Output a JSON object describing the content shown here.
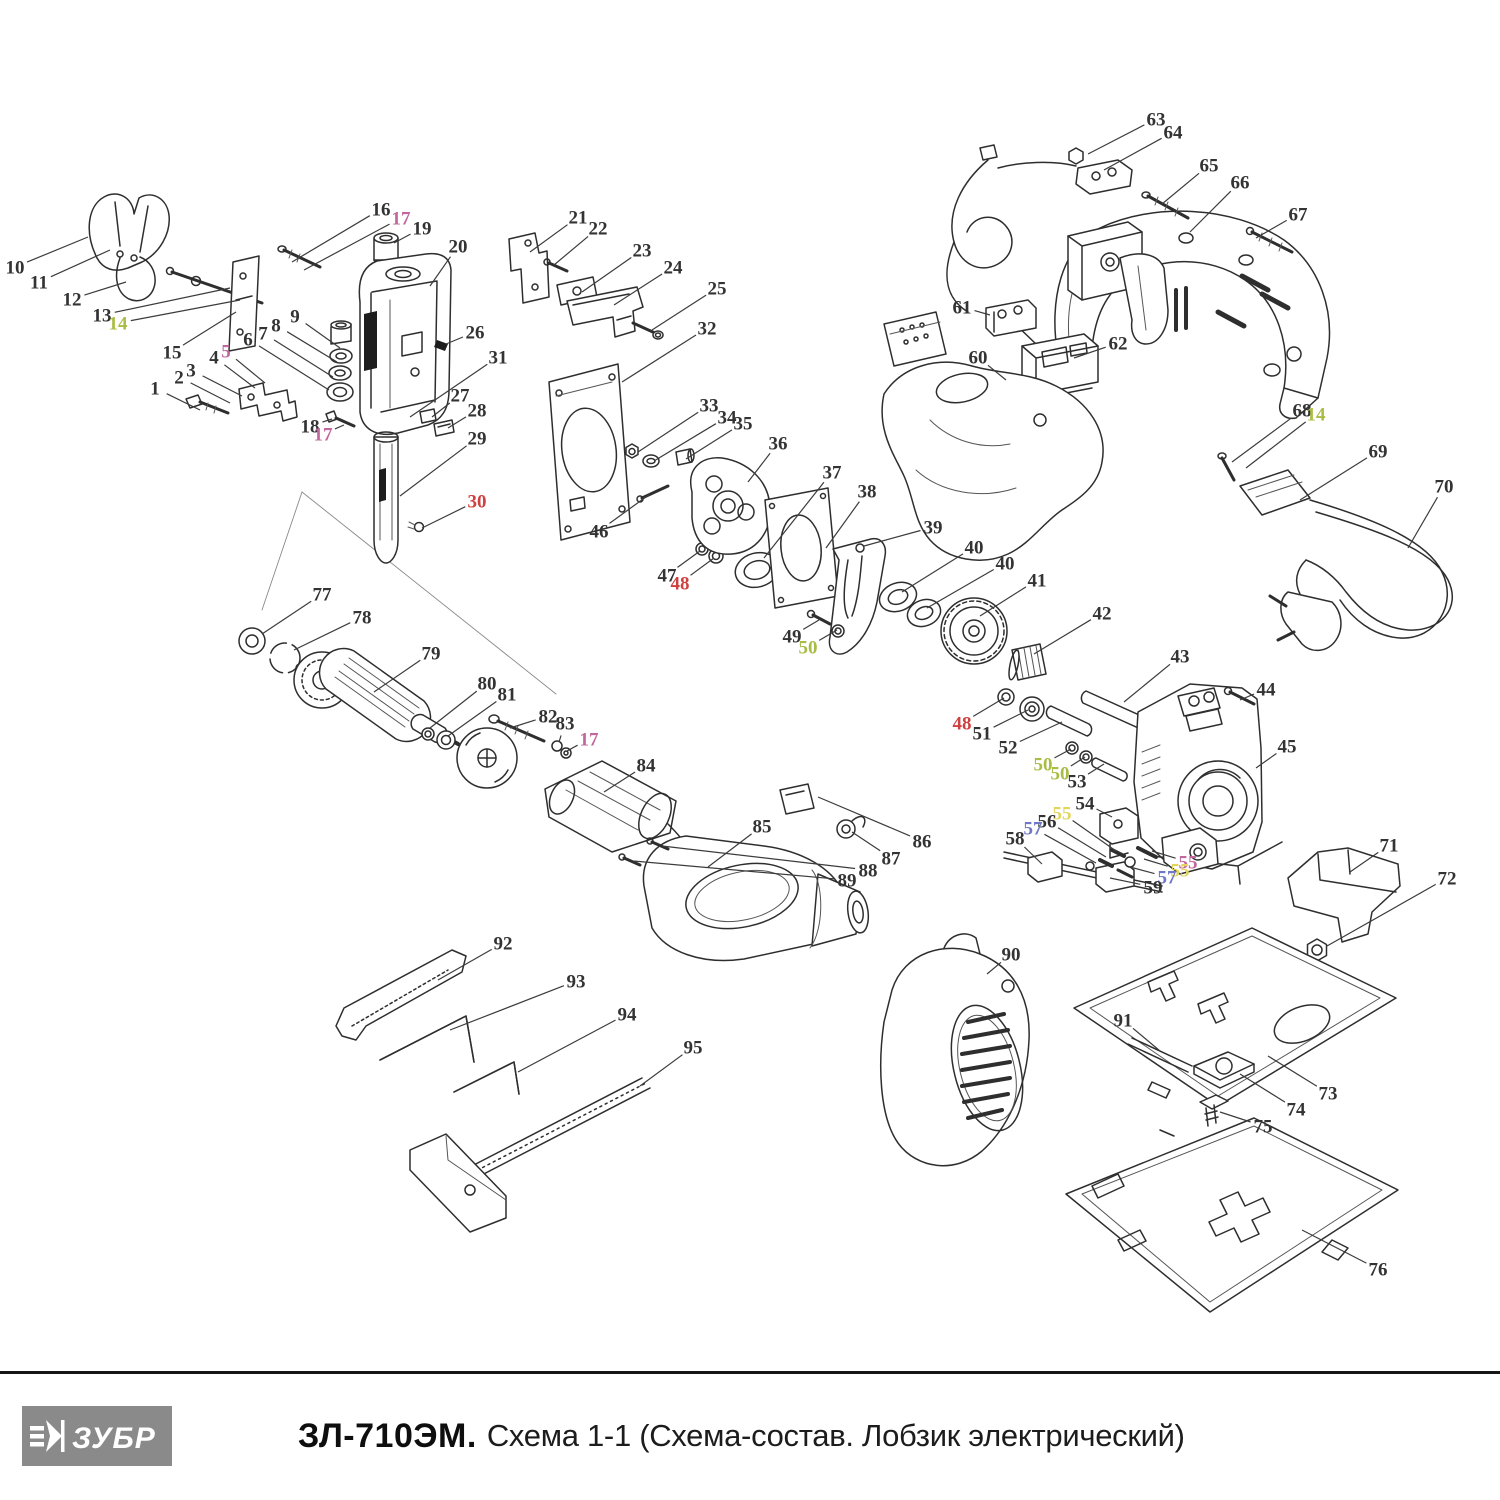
{
  "footer": {
    "brand": "ЗУБР",
    "model": "ЗЛ-710ЭМ.",
    "subtitle": "Схема 1-1 (Схема-состав. Лобзик электрический)",
    "logo_bg": "#8a8a8a"
  },
  "palette": {
    "k": "#333333",
    "r": "#cf4040",
    "p": "#c2679e",
    "g": "#a9bc45",
    "y": "#e3d45c",
    "b": "#6f78c8"
  },
  "diagram": {
    "description": "Exploded parts diagram of electric jigsaw ZL-710EM, schema 1-1",
    "leader_color": "#3c3c3c",
    "labels": [
      {
        "t": "1",
        "x": 155,
        "y": 388,
        "tx": 200,
        "ty": 410,
        "c": "k"
      },
      {
        "t": "2",
        "x": 179,
        "y": 377,
        "tx": 230,
        "ty": 403,
        "c": "k"
      },
      {
        "t": "3",
        "x": 191,
        "y": 370,
        "tx": 242,
        "ty": 396,
        "c": "k"
      },
      {
        "t": "4",
        "x": 214,
        "y": 357,
        "tx": 255,
        "ty": 388,
        "c": "k"
      },
      {
        "t": "5",
        "x": 226,
        "y": 351,
        "tx": 265,
        "ty": 383,
        "c": "p"
      },
      {
        "t": "6",
        "x": 248,
        "y": 339,
        "tx": 329,
        "ty": 390,
        "c": "k"
      },
      {
        "t": "7",
        "x": 263,
        "y": 333,
        "tx": 333,
        "ty": 377,
        "c": "k"
      },
      {
        "t": "8",
        "x": 276,
        "y": 325,
        "tx": 337,
        "ty": 362,
        "c": "k"
      },
      {
        "t": "9",
        "x": 295,
        "y": 316,
        "tx": 340,
        "ty": 348,
        "c": "k"
      },
      {
        "t": "10",
        "x": 15,
        "y": 267,
        "tx": 88,
        "ty": 237,
        "c": "k"
      },
      {
        "t": "11",
        "x": 39,
        "y": 282,
        "tx": 110,
        "ty": 250,
        "c": "k"
      },
      {
        "t": "12",
        "x": 72,
        "y": 299,
        "tx": 126,
        "ty": 282,
        "c": "k"
      },
      {
        "t": "13",
        "x": 102,
        "y": 315,
        "tx": 230,
        "ty": 288,
        "c": "k"
      },
      {
        "t": "14",
        "x": 118,
        "y": 323,
        "tx": 240,
        "ty": 300,
        "c": "g"
      },
      {
        "t": "15",
        "x": 172,
        "y": 352,
        "tx": 236,
        "ty": 312,
        "c": "k"
      },
      {
        "t": "16",
        "x": 381,
        "y": 209,
        "tx": 292,
        "ty": 262,
        "c": "k"
      },
      {
        "t": "17",
        "x": 401,
        "y": 218,
        "tx": 304,
        "ty": 270,
        "c": "p"
      },
      {
        "t": "18",
        "x": 310,
        "y": 426,
        "tx": 332,
        "ty": 419,
        "c": "k"
      },
      {
        "t": "17",
        "x": 323,
        "y": 434,
        "tx": 344,
        "ty": 425,
        "c": "p"
      },
      {
        "t": "19",
        "x": 422,
        "y": 228,
        "tx": 394,
        "ty": 243,
        "c": "k"
      },
      {
        "t": "20",
        "x": 458,
        "y": 246,
        "tx": 430,
        "ty": 286,
        "c": "k"
      },
      {
        "t": "21",
        "x": 578,
        "y": 217,
        "tx": 530,
        "ty": 252,
        "c": "k"
      },
      {
        "t": "22",
        "x": 598,
        "y": 228,
        "tx": 554,
        "ty": 265,
        "c": "k"
      },
      {
        "t": "23",
        "x": 642,
        "y": 250,
        "tx": 582,
        "ty": 292,
        "c": "k"
      },
      {
        "t": "24",
        "x": 673,
        "y": 267,
        "tx": 614,
        "ty": 305,
        "c": "k"
      },
      {
        "t": "25",
        "x": 717,
        "y": 288,
        "tx": 652,
        "ty": 330,
        "c": "k"
      },
      {
        "t": "26",
        "x": 475,
        "y": 332,
        "tx": 446,
        "ty": 344,
        "c": "k"
      },
      {
        "t": "27",
        "x": 460,
        "y": 395,
        "tx": 432,
        "ty": 417,
        "c": "k"
      },
      {
        "t": "28",
        "x": 477,
        "y": 410,
        "tx": 448,
        "ty": 428,
        "c": "k"
      },
      {
        "t": "29",
        "x": 477,
        "y": 438,
        "tx": 400,
        "ty": 496,
        "c": "k"
      },
      {
        "t": "30",
        "x": 477,
        "y": 501,
        "tx": 422,
        "ty": 528,
        "c": "r"
      },
      {
        "t": "31",
        "x": 498,
        "y": 357,
        "tx": 410,
        "ty": 417,
        "c": "k"
      },
      {
        "t": "32",
        "x": 707,
        "y": 328,
        "tx": 622,
        "ty": 382,
        "c": "k"
      },
      {
        "t": "33",
        "x": 709,
        "y": 405,
        "tx": 638,
        "ty": 452,
        "c": "k"
      },
      {
        "t": "34",
        "x": 727,
        "y": 417,
        "tx": 654,
        "ty": 461,
        "c": "k"
      },
      {
        "t": "35",
        "x": 743,
        "y": 423,
        "tx": 686,
        "ty": 459,
        "c": "k"
      },
      {
        "t": "36",
        "x": 778,
        "y": 443,
        "tx": 748,
        "ty": 482,
        "c": "k"
      },
      {
        "t": "37",
        "x": 832,
        "y": 472,
        "tx": 764,
        "ty": 558,
        "c": "k"
      },
      {
        "t": "38",
        "x": 867,
        "y": 491,
        "tx": 826,
        "ty": 548,
        "c": "k"
      },
      {
        "t": "39",
        "x": 933,
        "y": 527,
        "tx": 864,
        "ty": 546,
        "c": "k"
      },
      {
        "t": "40",
        "x": 974,
        "y": 547,
        "tx": 902,
        "ty": 592,
        "c": "k"
      },
      {
        "t": "40",
        "x": 1005,
        "y": 563,
        "tx": 927,
        "ty": 608,
        "c": "k"
      },
      {
        "t": "41",
        "x": 1037,
        "y": 580,
        "tx": 980,
        "ty": 616,
        "c": "k"
      },
      {
        "t": "42",
        "x": 1102,
        "y": 613,
        "tx": 1034,
        "ty": 654,
        "c": "k"
      },
      {
        "t": "43",
        "x": 1180,
        "y": 656,
        "tx": 1124,
        "ty": 702,
        "c": "k"
      },
      {
        "t": "44",
        "x": 1266,
        "y": 689,
        "tx": 1240,
        "ty": 700,
        "c": "k"
      },
      {
        "t": "45",
        "x": 1287,
        "y": 746,
        "tx": 1256,
        "ty": 768,
        "c": "k"
      },
      {
        "t": "46",
        "x": 599,
        "y": 531,
        "tx": 650,
        "ty": 494,
        "c": "k"
      },
      {
        "t": "47",
        "x": 667,
        "y": 575,
        "tx": 700,
        "ty": 551,
        "c": "k"
      },
      {
        "t": "48",
        "x": 680,
        "y": 583,
        "tx": 714,
        "ty": 558,
        "c": "r"
      },
      {
        "t": "49",
        "x": 792,
        "y": 636,
        "tx": 819,
        "ty": 620,
        "c": "k"
      },
      {
        "t": "50",
        "x": 808,
        "y": 647,
        "tx": 837,
        "ty": 630,
        "c": "g"
      },
      {
        "t": "48",
        "x": 962,
        "y": 723,
        "tx": 1004,
        "ty": 698,
        "c": "r"
      },
      {
        "t": "51",
        "x": 982,
        "y": 733,
        "tx": 1028,
        "ty": 710,
        "c": "k"
      },
      {
        "t": "52",
        "x": 1008,
        "y": 747,
        "tx": 1062,
        "ty": 722,
        "c": "k"
      },
      {
        "t": "50",
        "x": 1043,
        "y": 764,
        "tx": 1071,
        "ty": 749,
        "c": "g"
      },
      {
        "t": "50",
        "x": 1060,
        "y": 773,
        "tx": 1085,
        "ty": 757,
        "c": "g"
      },
      {
        "t": "53",
        "x": 1077,
        "y": 781,
        "tx": 1104,
        "ty": 764,
        "c": "k"
      },
      {
        "t": "54",
        "x": 1085,
        "y": 803,
        "tx": 1112,
        "ty": 817,
        "c": "k"
      },
      {
        "t": "55",
        "x": 1062,
        "y": 813,
        "tx": 1116,
        "ty": 851,
        "c": "y"
      },
      {
        "t": "56",
        "x": 1047,
        "y": 821,
        "tx": 1106,
        "ty": 857,
        "c": "k"
      },
      {
        "t": "57",
        "x": 1033,
        "y": 828,
        "tx": 1096,
        "ty": 863,
        "c": "b"
      },
      {
        "t": "58",
        "x": 1015,
        "y": 838,
        "tx": 1042,
        "ty": 864,
        "c": "k"
      },
      {
        "t": "55",
        "x": 1188,
        "y": 862,
        "tx": 1152,
        "ty": 851,
        "c": "p"
      },
      {
        "t": "55",
        "x": 1180,
        "y": 870,
        "tx": 1144,
        "ty": 859,
        "c": "y"
      },
      {
        "t": "57",
        "x": 1167,
        "y": 877,
        "tx": 1130,
        "ty": 867,
        "c": "b"
      },
      {
        "t": "59",
        "x": 1153,
        "y": 887,
        "tx": 1110,
        "ty": 878,
        "c": "k"
      },
      {
        "t": "60",
        "x": 978,
        "y": 357,
        "tx": 1006,
        "ty": 380,
        "c": "k"
      },
      {
        "t": "61",
        "x": 962,
        "y": 307,
        "tx": 990,
        "ty": 315,
        "c": "k"
      },
      {
        "t": "62",
        "x": 1118,
        "y": 343,
        "tx": 1074,
        "ty": 358,
        "c": "k"
      },
      {
        "t": "63",
        "x": 1156,
        "y": 119,
        "tx": 1088,
        "ty": 154,
        "c": "k"
      },
      {
        "t": "64",
        "x": 1173,
        "y": 132,
        "tx": 1104,
        "ty": 170,
        "c": "k"
      },
      {
        "t": "65",
        "x": 1209,
        "y": 165,
        "tx": 1162,
        "ty": 204,
        "c": "k"
      },
      {
        "t": "66",
        "x": 1240,
        "y": 182,
        "tx": 1190,
        "ty": 232,
        "c": "k"
      },
      {
        "t": "67",
        "x": 1298,
        "y": 214,
        "tx": 1256,
        "ty": 238,
        "c": "k"
      },
      {
        "t": "68",
        "x": 1302,
        "y": 410,
        "tx": 1232,
        "ty": 462,
        "c": "k"
      },
      {
        "t": "14",
        "x": 1316,
        "y": 414,
        "tx": 1246,
        "ty": 468,
        "c": "g"
      },
      {
        "t": "69",
        "x": 1378,
        "y": 451,
        "tx": 1300,
        "ty": 500,
        "c": "k"
      },
      {
        "t": "70",
        "x": 1444,
        "y": 486,
        "tx": 1408,
        "ty": 548,
        "c": "k"
      },
      {
        "t": "71",
        "x": 1389,
        "y": 845,
        "tx": 1350,
        "ty": 872,
        "c": "k"
      },
      {
        "t": "72",
        "x": 1447,
        "y": 878,
        "tx": 1327,
        "ty": 946,
        "c": "k"
      },
      {
        "t": "73",
        "x": 1328,
        "y": 1093,
        "tx": 1268,
        "ty": 1056,
        "c": "k"
      },
      {
        "t": "74",
        "x": 1296,
        "y": 1109,
        "tx": 1240,
        "ty": 1074,
        "c": "k"
      },
      {
        "t": "75",
        "x": 1263,
        "y": 1126,
        "tx": 1220,
        "ty": 1112,
        "c": "k"
      },
      {
        "t": "76",
        "x": 1378,
        "y": 1269,
        "tx": 1302,
        "ty": 1230,
        "c": "k"
      },
      {
        "t": "77",
        "x": 322,
        "y": 594,
        "tx": 262,
        "ty": 634,
        "c": "k"
      },
      {
        "t": "78",
        "x": 362,
        "y": 617,
        "tx": 294,
        "ty": 650,
        "c": "k"
      },
      {
        "t": "79",
        "x": 431,
        "y": 653,
        "tx": 374,
        "ty": 692,
        "c": "k"
      },
      {
        "t": "80",
        "x": 487,
        "y": 683,
        "tx": 430,
        "ty": 728,
        "c": "k"
      },
      {
        "t": "81",
        "x": 507,
        "y": 694,
        "tx": 448,
        "ty": 736,
        "c": "k"
      },
      {
        "t": "82",
        "x": 548,
        "y": 716,
        "tx": 510,
        "ty": 728,
        "c": "k"
      },
      {
        "t": "83",
        "x": 565,
        "y": 723,
        "tx": 559,
        "ty": 742,
        "c": "k"
      },
      {
        "t": "17",
        "x": 589,
        "y": 739,
        "tx": 567,
        "ty": 751,
        "c": "p"
      },
      {
        "t": "84",
        "x": 646,
        "y": 765,
        "tx": 604,
        "ty": 792,
        "c": "k"
      },
      {
        "t": "85",
        "x": 762,
        "y": 826,
        "tx": 708,
        "ty": 867,
        "c": "k"
      },
      {
        "t": "86",
        "x": 922,
        "y": 841,
        "tx": 818,
        "ty": 797,
        "c": "k"
      },
      {
        "t": "87",
        "x": 891,
        "y": 858,
        "tx": 852,
        "ty": 832,
        "c": "k"
      },
      {
        "t": "88",
        "x": 868,
        "y": 870,
        "tx": 662,
        "ty": 846,
        "c": "k"
      },
      {
        "t": "89",
        "x": 847,
        "y": 880,
        "tx": 634,
        "ty": 861,
        "c": "k"
      },
      {
        "t": "90",
        "x": 1011,
        "y": 954,
        "tx": 987,
        "ty": 974,
        "c": "k"
      },
      {
        "t": "91",
        "x": 1123,
        "y": 1020,
        "tx": 1160,
        "ty": 1051,
        "c": "k"
      },
      {
        "t": "92",
        "x": 503,
        "y": 943,
        "tx": 438,
        "ty": 980,
        "c": "k"
      },
      {
        "t": "93",
        "x": 576,
        "y": 981,
        "tx": 450,
        "ty": 1030,
        "c": "k"
      },
      {
        "t": "94",
        "x": 627,
        "y": 1014,
        "tx": 518,
        "ty": 1072,
        "c": "k"
      },
      {
        "t": "95",
        "x": 693,
        "y": 1047,
        "tx": 640,
        "ty": 1086,
        "c": "k"
      }
    ]
  }
}
